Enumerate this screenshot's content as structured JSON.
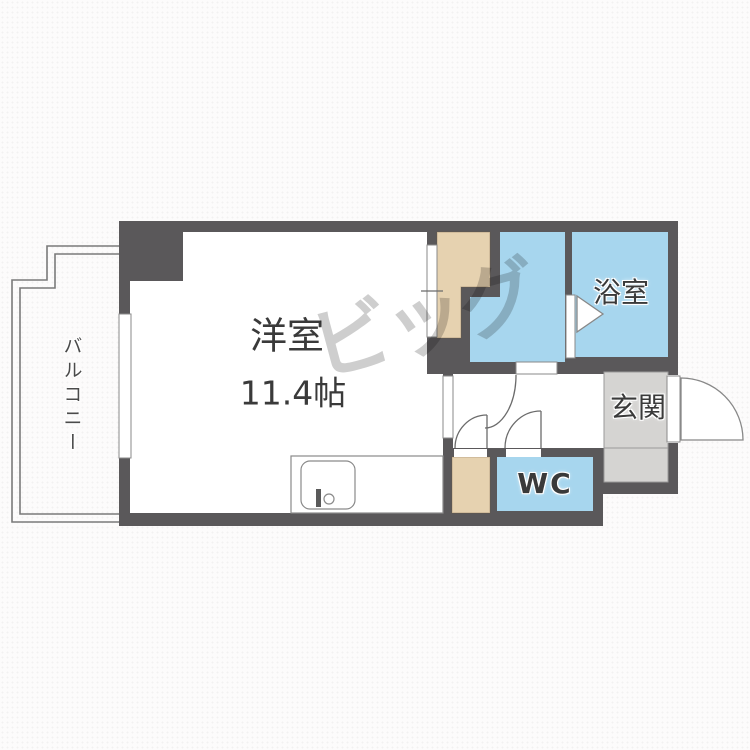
{
  "colors": {
    "wall": "#5a585a",
    "water_room": "#a7d6ee",
    "closet": "#e6d2b0",
    "genkan": "#d5d4d2",
    "line": "#6b6b6b",
    "text": "#3a3a3a",
    "watermark": "#c6c6c6",
    "background": "#fcfbfb"
  },
  "rooms": {
    "balcony": {
      "label": "バルコニー"
    },
    "main_room": {
      "label": "洋室",
      "size": "11.4帖"
    },
    "bathroom": {
      "label": "浴室"
    },
    "entrance": {
      "label": "玄関"
    },
    "toilet": {
      "label": "WC"
    }
  },
  "watermark": {
    "text": "ビッグ"
  }
}
